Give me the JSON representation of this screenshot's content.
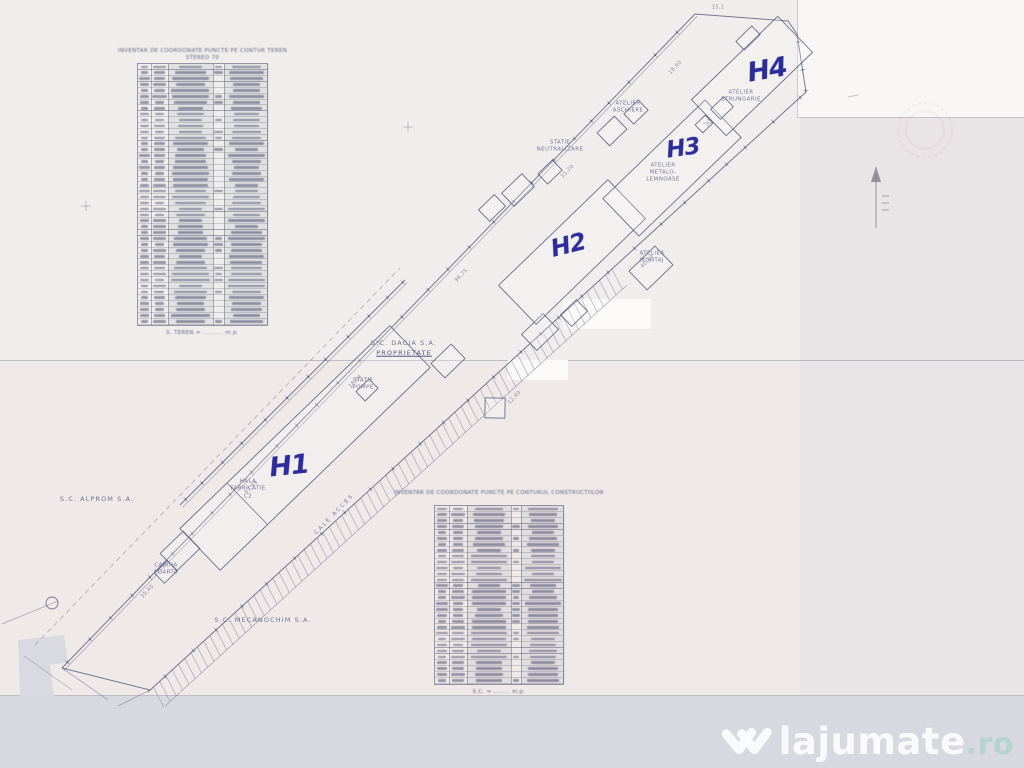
{
  "watermark": {
    "brand": "lajumate",
    "tld": ".ro",
    "logo": "w-chevrons-icon"
  },
  "plan": {
    "handwritten_labels": [
      {
        "text": "H1",
        "x": 289,
        "y": 466,
        "rot": -6,
        "size": 27
      },
      {
        "text": "H2",
        "x": 568,
        "y": 245,
        "rot": -14,
        "size": 24
      },
      {
        "text": "H3",
        "x": 683,
        "y": 149,
        "rot": -8,
        "size": 23
      },
      {
        "text": "H4",
        "x": 767,
        "y": 70,
        "rot": -10,
        "size": 27
      }
    ],
    "company_labels": [
      {
        "text": "S.C. DACIA S.A.",
        "x": 404,
        "y": 343
      },
      {
        "text": "PROPRIETATE",
        "x": 404,
        "y": 353,
        "underline": true
      },
      {
        "text": "S.C. ALPROM S.A.",
        "x": 97,
        "y": 499
      },
      {
        "text": "S.C. MECANOCHIM S.A.",
        "x": 263,
        "y": 620
      }
    ],
    "feature_labels": [
      {
        "text": "HALA",
        "x": 248,
        "y": 482
      },
      {
        "text": "FABRICATIE",
        "x": 248,
        "y": 489
      },
      {
        "text": "C2",
        "x": 248,
        "y": 497
      },
      {
        "text": "CALE ACCES",
        "x": 335,
        "y": 515,
        "rot": -46,
        "ls": 2
      },
      {
        "text": "STATIE",
        "x": 363,
        "y": 381
      },
      {
        "text": "POMPE",
        "x": 363,
        "y": 388
      },
      {
        "text": "CABINA",
        "x": 166,
        "y": 566
      },
      {
        "text": "POARTA",
        "x": 166,
        "y": 573
      },
      {
        "text": "ATELIER",
        "x": 652,
        "y": 254
      },
      {
        "text": "MONTAJ",
        "x": 652,
        "y": 261
      },
      {
        "text": "STATIE",
        "x": 560,
        "y": 143
      },
      {
        "text": "NEUTRALIZARE",
        "x": 560,
        "y": 150
      },
      {
        "text": "ATELIER",
        "x": 663,
        "y": 166
      },
      {
        "text": "METALO-",
        "x": 663,
        "y": 173
      },
      {
        "text": "LEMNOASE",
        "x": 663,
        "y": 180
      },
      {
        "text": "ATELIER",
        "x": 741,
        "y": 93
      },
      {
        "text": "STRUNGARIE",
        "x": 741,
        "y": 100
      },
      {
        "text": "ATELIER",
        "x": 628,
        "y": 104
      },
      {
        "text": "ASCHIERE",
        "x": 628,
        "y": 111
      }
    ],
    "dimension_labels": [
      {
        "text": "35,40",
        "x": 148,
        "y": 592,
        "rot": -46
      },
      {
        "text": "57,49",
        "x": 252,
        "y": 488,
        "rot": -46
      },
      {
        "text": "28,04",
        "x": 356,
        "y": 382,
        "rot": -46
      },
      {
        "text": "96,75",
        "x": 462,
        "y": 276,
        "rot": -46
      },
      {
        "text": "31,20",
        "x": 568,
        "y": 172,
        "rot": -46
      },
      {
        "text": "18,60",
        "x": 676,
        "y": 68,
        "rot": -46
      },
      {
        "text": "12,40",
        "x": 515,
        "y": 398,
        "rot": -46
      },
      {
        "text": "40,10",
        "x": 648,
        "y": 262,
        "rot": -46
      },
      {
        "text": "15,1",
        "x": 718,
        "y": 8,
        "rot": 0
      }
    ],
    "tables": [
      {
        "title_lines": [
          "INVENTAR DE COORDONATE PUNCTE PE CONTUR TEREN",
          "STEREO 70"
        ],
        "caption": "S. TEREN = .......... m.p.",
        "rows": 44,
        "x": 137,
        "y": 48,
        "w": 131,
        "grid_top": 63,
        "grid_h": 263,
        "cols": [
          13,
          17,
          45,
          11,
          45
        ]
      },
      {
        "title_lines": [
          "INVENTAR DE COORDONATE PUNCTE PE CONTURUL CONSTRUCTIILOR"
        ],
        "caption": "S.C. = ........ m.p.",
        "rows": 30,
        "x": 434,
        "y": 490,
        "w": 130,
        "grid_top": 505,
        "grid_h": 180,
        "cols": [
          14,
          18,
          44,
          10,
          44
        ]
      }
    ],
    "colors": {
      "ink": "#565a7e",
      "handwriting": "#2c2c9c",
      "paper": "#f0eeec"
    }
  }
}
